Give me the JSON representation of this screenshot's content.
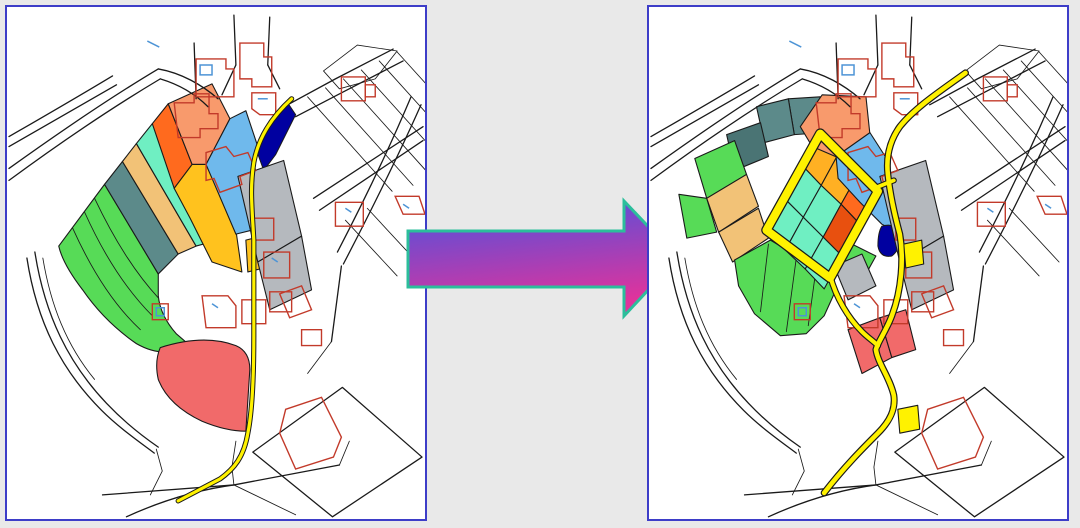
{
  "figure": {
    "kind": "before-after map comparison",
    "left_panel_role": "before",
    "right_panel_role": "after"
  },
  "palette": {
    "background": "#E9E9E9",
    "panel_bg": "#FFFFFF",
    "panel_border": "#3D3DC8",
    "line_black": "#1A1A1A",
    "building_red": "#C23A2A",
    "detail_blue": "#4D94D6",
    "road_yellow": "#FFF200",
    "water_navy": "#0000A0",
    "parcel_green": "#57DB57",
    "parcel_slate": "#5C8A8A",
    "parcel_slate_dark": "#4A7474",
    "parcel_tan": "#F2C277",
    "parcel_turquoise": "#6FEFC2",
    "parcel_orange": "#FF6A1E",
    "parcel_orange_dark": "#E8500F",
    "parcel_salmon": "#F89A6C",
    "parcel_gold": "#FFC21E",
    "parcel_amber": "#FFB023",
    "parcel_blue": "#6FB9EC",
    "parcel_gray": "#B5B9BE",
    "parcel_red": "#F16A6A",
    "arrow_blue": "#4953E0",
    "arrow_magenta": "#E0339C",
    "arrow_outline": "#2BBE9B"
  },
  "left_map": {
    "role": "before",
    "parcels": [
      {
        "id": "green-strip",
        "color": "parcel_green"
      },
      {
        "id": "slate-strip",
        "color": "parcel_slate"
      },
      {
        "id": "tan-strip",
        "color": "parcel_tan"
      },
      {
        "id": "turquoise-strip",
        "color": "parcel_turquoise"
      },
      {
        "id": "orange-strip",
        "color": "parcel_orange"
      },
      {
        "id": "salmon-lot",
        "color": "parcel_salmon"
      },
      {
        "id": "gold-strip",
        "color": "parcel_gold"
      },
      {
        "id": "blue-area",
        "color": "parcel_blue"
      },
      {
        "id": "gray-lots",
        "color": "parcel_gray"
      },
      {
        "id": "red-blob",
        "color": "parcel_red"
      },
      {
        "id": "pond",
        "color": "water_navy"
      }
    ]
  },
  "right_map": {
    "role": "after",
    "parcels": [
      {
        "id": "slate-squares",
        "color": "parcel_slate"
      },
      {
        "id": "green-squares",
        "color": "parcel_green"
      },
      {
        "id": "tan-squares",
        "color": "parcel_tan"
      },
      {
        "id": "inner-amber-cells",
        "color": "parcel_amber"
      },
      {
        "id": "inner-turquoise-cells",
        "color": "parcel_turquoise"
      },
      {
        "id": "inner-orange-cell",
        "color": "parcel_orange"
      },
      {
        "id": "inner-dark-orange-cell",
        "color": "parcel_orange_dark"
      },
      {
        "id": "salmon-lot",
        "color": "parcel_salmon"
      },
      {
        "id": "blue-area",
        "color": "parcel_blue"
      },
      {
        "id": "gray-lots",
        "color": "parcel_gray"
      },
      {
        "id": "red-lots",
        "color": "parcel_red"
      },
      {
        "id": "pond",
        "color": "water_navy"
      }
    ]
  }
}
